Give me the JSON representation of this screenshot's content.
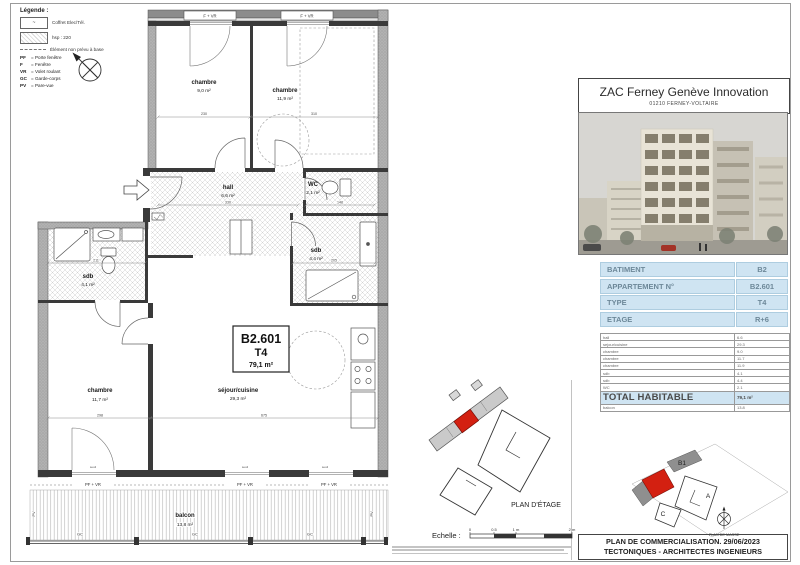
{
  "legend": {
    "title": "Légende :",
    "coffret_symbol": "~",
    "coffret_label": "Coffret Elec/Tél.",
    "hsp_label": "hsp : 220",
    "dash_label": "Élément non prévu à base",
    "abbreviations": [
      {
        "abbr": "PF",
        "label": "= Porte fenêtre"
      },
      {
        "abbr": "F",
        "label": "= Fenêtre"
      },
      {
        "abbr": "VR",
        "label": "= Volet roulant"
      },
      {
        "abbr": "GC",
        "label": "= Garde-corps"
      },
      {
        "abbr": "PV",
        "label": "= Pare-vue"
      }
    ]
  },
  "plan": {
    "apartment": {
      "number": "B2.601",
      "type": "T4",
      "area": "79,1 m²"
    },
    "rooms": {
      "chambre1": {
        "name": "chambre",
        "area": "9,0 m²"
      },
      "chambre2": {
        "name": "chambre",
        "area": "11,9 m²"
      },
      "chambre3": {
        "name": "chambre",
        "area": "11,7 m²"
      },
      "hall": {
        "name": "hall",
        "area": "6,6 m²"
      },
      "wc": {
        "name": "WC",
        "area": "2,1 m²"
      },
      "sdb1": {
        "name": "sdb",
        "area": "4,1 m²"
      },
      "sdb2": {
        "name": "sdb",
        "area": "4,4 m²"
      },
      "sejour": {
        "name": "séjour/cuisine",
        "area": "29,3 m²"
      },
      "balcon": {
        "name": "balcon",
        "area": "13,8 m²"
      }
    },
    "labels": {
      "f_vr": "F + VR",
      "pf_vr": "PF + VR",
      "gc": "GC",
      "pv": "PV",
      "seuil": "seuil"
    },
    "dims": {
      "d1": "230",
      "d2": "310",
      "d3": "330",
      "d4": "148",
      "d5": "211",
      "d6": "205",
      "d7": "298",
      "d8": "675"
    }
  },
  "floor_key": {
    "title": "PLAN D'ÉTAGE"
  },
  "scale_bar": {
    "label": "Echelle :",
    "t0": "0",
    "t1": "0.5",
    "t2": "1 m",
    "t3": "2 m"
  },
  "panel": {
    "title": "ZAC Ferney Genève Innovation",
    "subtitle": "01210 FERNEY-VOLTAIRE",
    "info_table": [
      {
        "label": "BATIMENT",
        "value": "B2"
      },
      {
        "label": "APPARTEMENT N°",
        "value": "B2.601"
      },
      {
        "label": "TYPE",
        "value": "T4"
      },
      {
        "label": "ETAGE",
        "value": "R+6"
      }
    ],
    "area_table": [
      {
        "label": "hall",
        "value": "6.6"
      },
      {
        "label": "sejour/cuisine",
        "value": "29.3"
      },
      {
        "label": "chambre",
        "value": "9.0"
      },
      {
        "label": "chambre",
        "value": "11.7"
      },
      {
        "label": "chambre",
        "value": "11.9"
      },
      {
        "label": "sdb",
        "value": "4.1"
      },
      {
        "label": "sdb",
        "value": "4.4"
      },
      {
        "label": "WC",
        "value": "2.1"
      }
    ],
    "total_row": {
      "label": "TOTAL HABITABLE",
      "value": "79,1 m²"
    },
    "balcon_row": {
      "label": "balcon",
      "value": "13.8"
    },
    "site_key": {
      "title": "PLAN DE MASSE",
      "b1": "B1",
      "a": "A",
      "c": "C"
    },
    "footer_line1": "PLAN DE COMMERCIALISATION. 29/06/2023",
    "footer_line2": "TECTONIQUES - ARCHITECTES INGENIEURS"
  },
  "colors": {
    "highlight_red": "#d32011",
    "table_blue": "#cfe4f2",
    "table_text": "#6d8899"
  }
}
